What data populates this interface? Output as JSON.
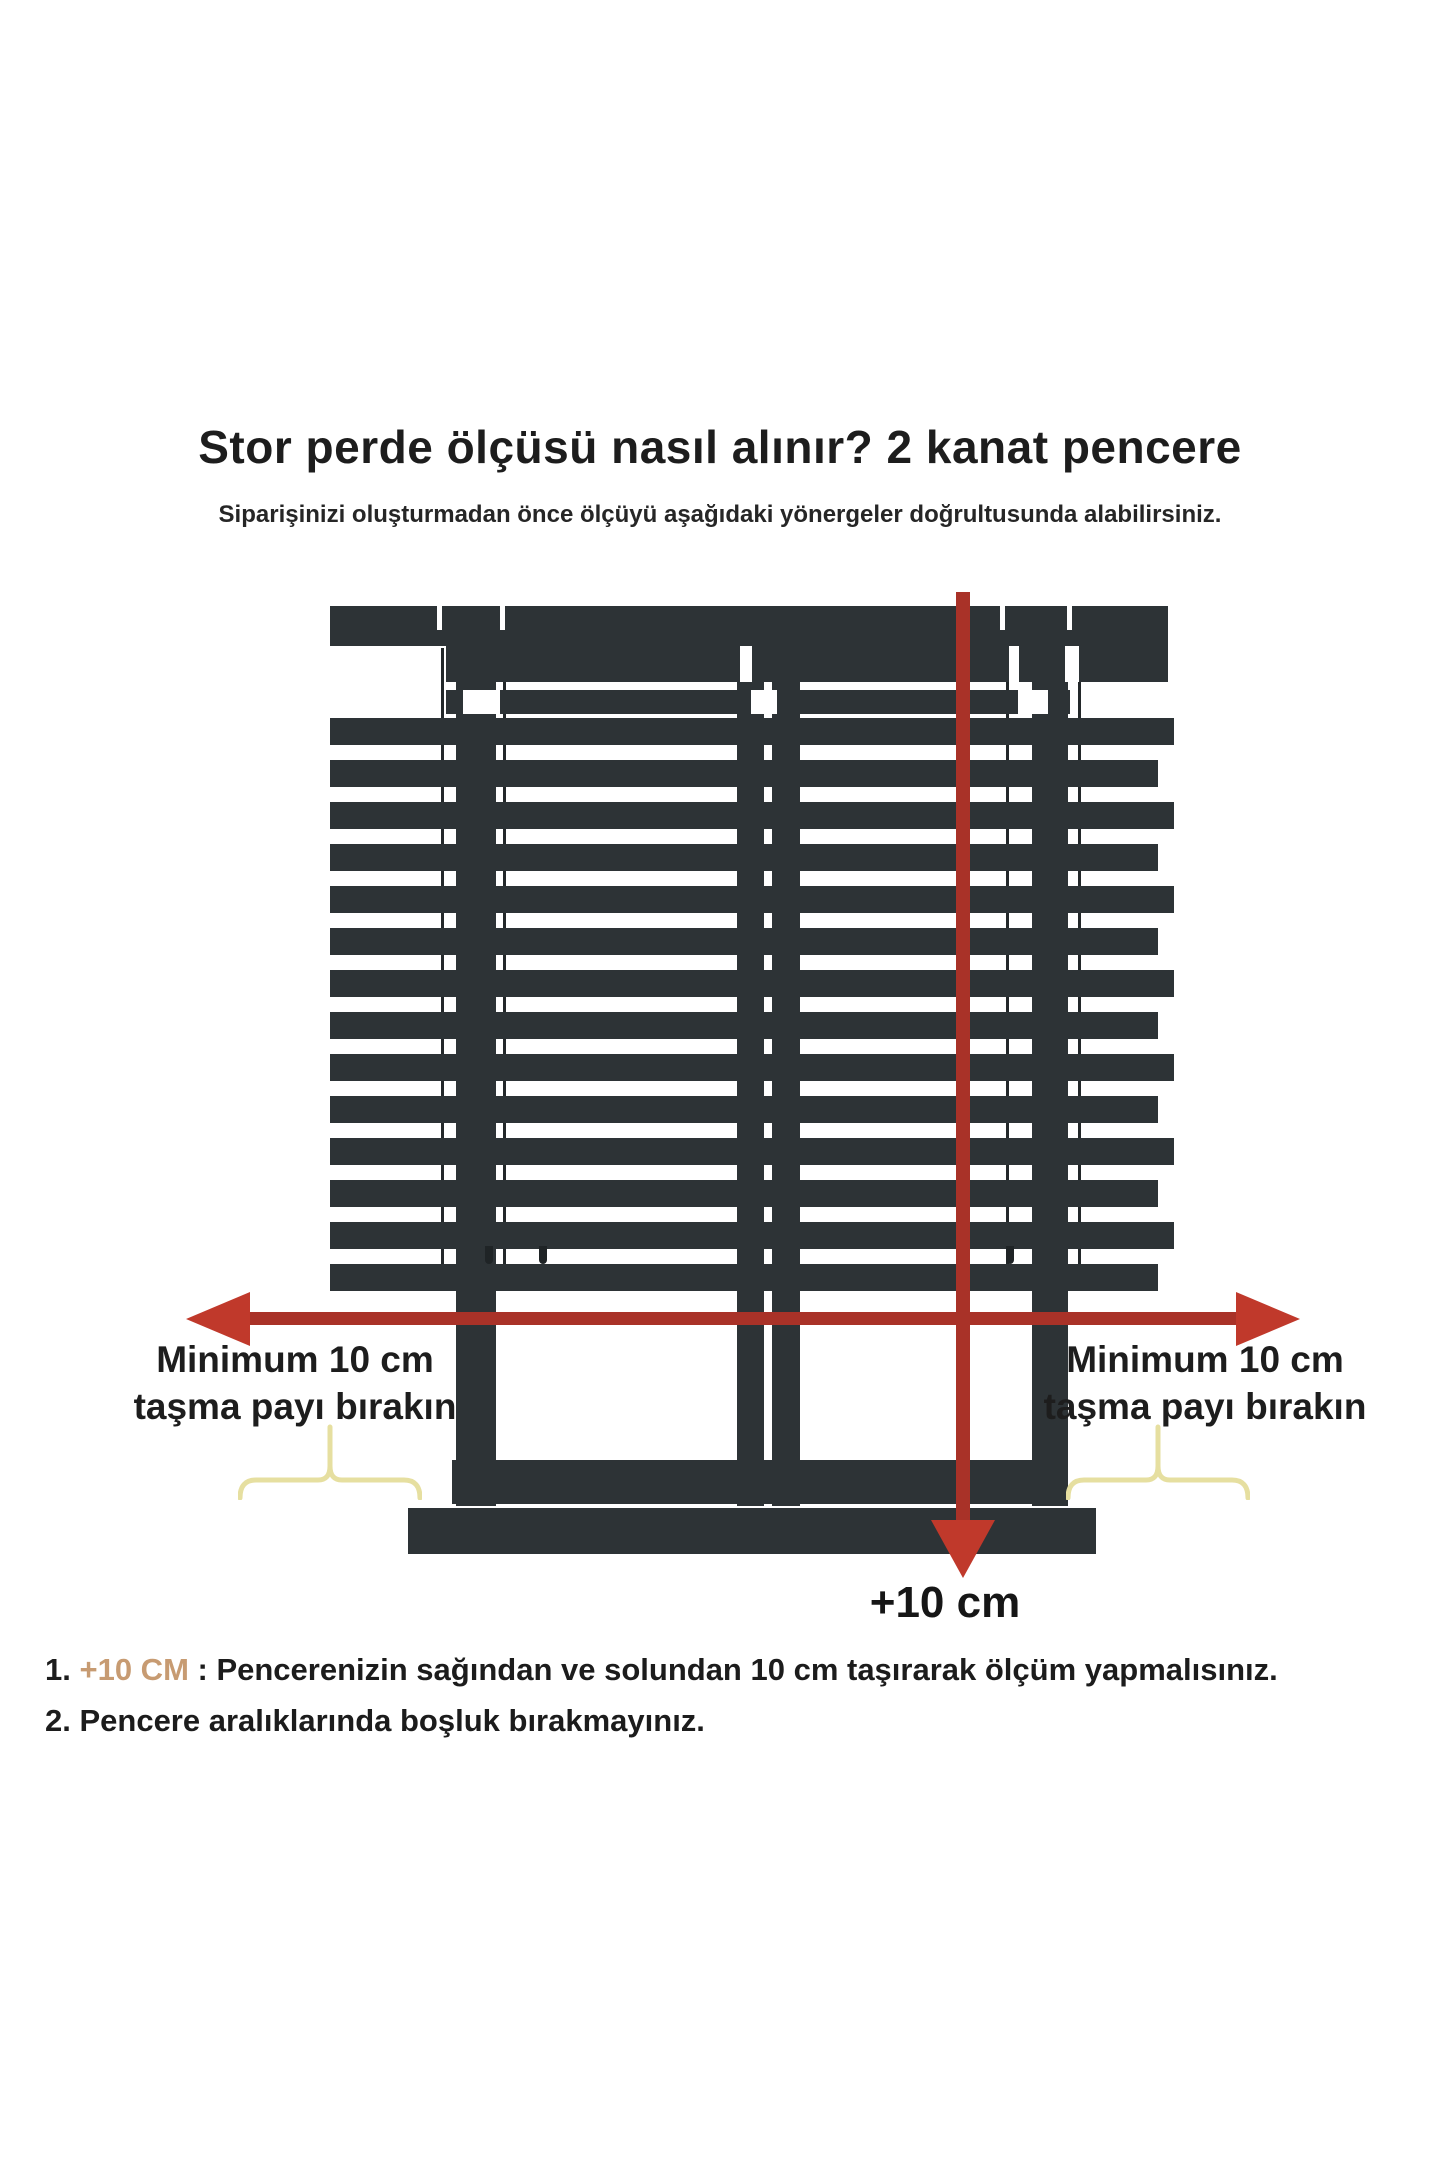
{
  "title": "Stor perde ölçüsü nasıl alınır? 2 kanat pencere",
  "subtitle": "Siparişinizi oluşturmadan önce ölçüyü aşağıdaki yönergeler doğrultusunda alabilirsiniz.",
  "diagram": {
    "left_note": {
      "line1": "Minimum 10 cm",
      "line2": "taşma payı bırakın"
    },
    "right_note": {
      "line1": "Minimum 10 cm",
      "line2": "taşma payı bırakın"
    },
    "bottom_measure_label": "+10 cm"
  },
  "instructions": [
    {
      "num": "1.",
      "highlight": "+10 CM",
      "rest": " : Pencerenizin sağından ve solundan 10 cm taşırarak ölçüm yapmalısınız."
    },
    {
      "num": "2.",
      "highlight": "",
      "rest": " Pencere aralıklarında boşluk bırakmayınız."
    }
  ],
  "colors": {
    "frame": "#2d3336",
    "arrow": "#a93228",
    "arrowhead": "#c0392b",
    "brace": "#e6dfa0",
    "highlight": "#c79b72",
    "text": "#1d1d1d"
  }
}
